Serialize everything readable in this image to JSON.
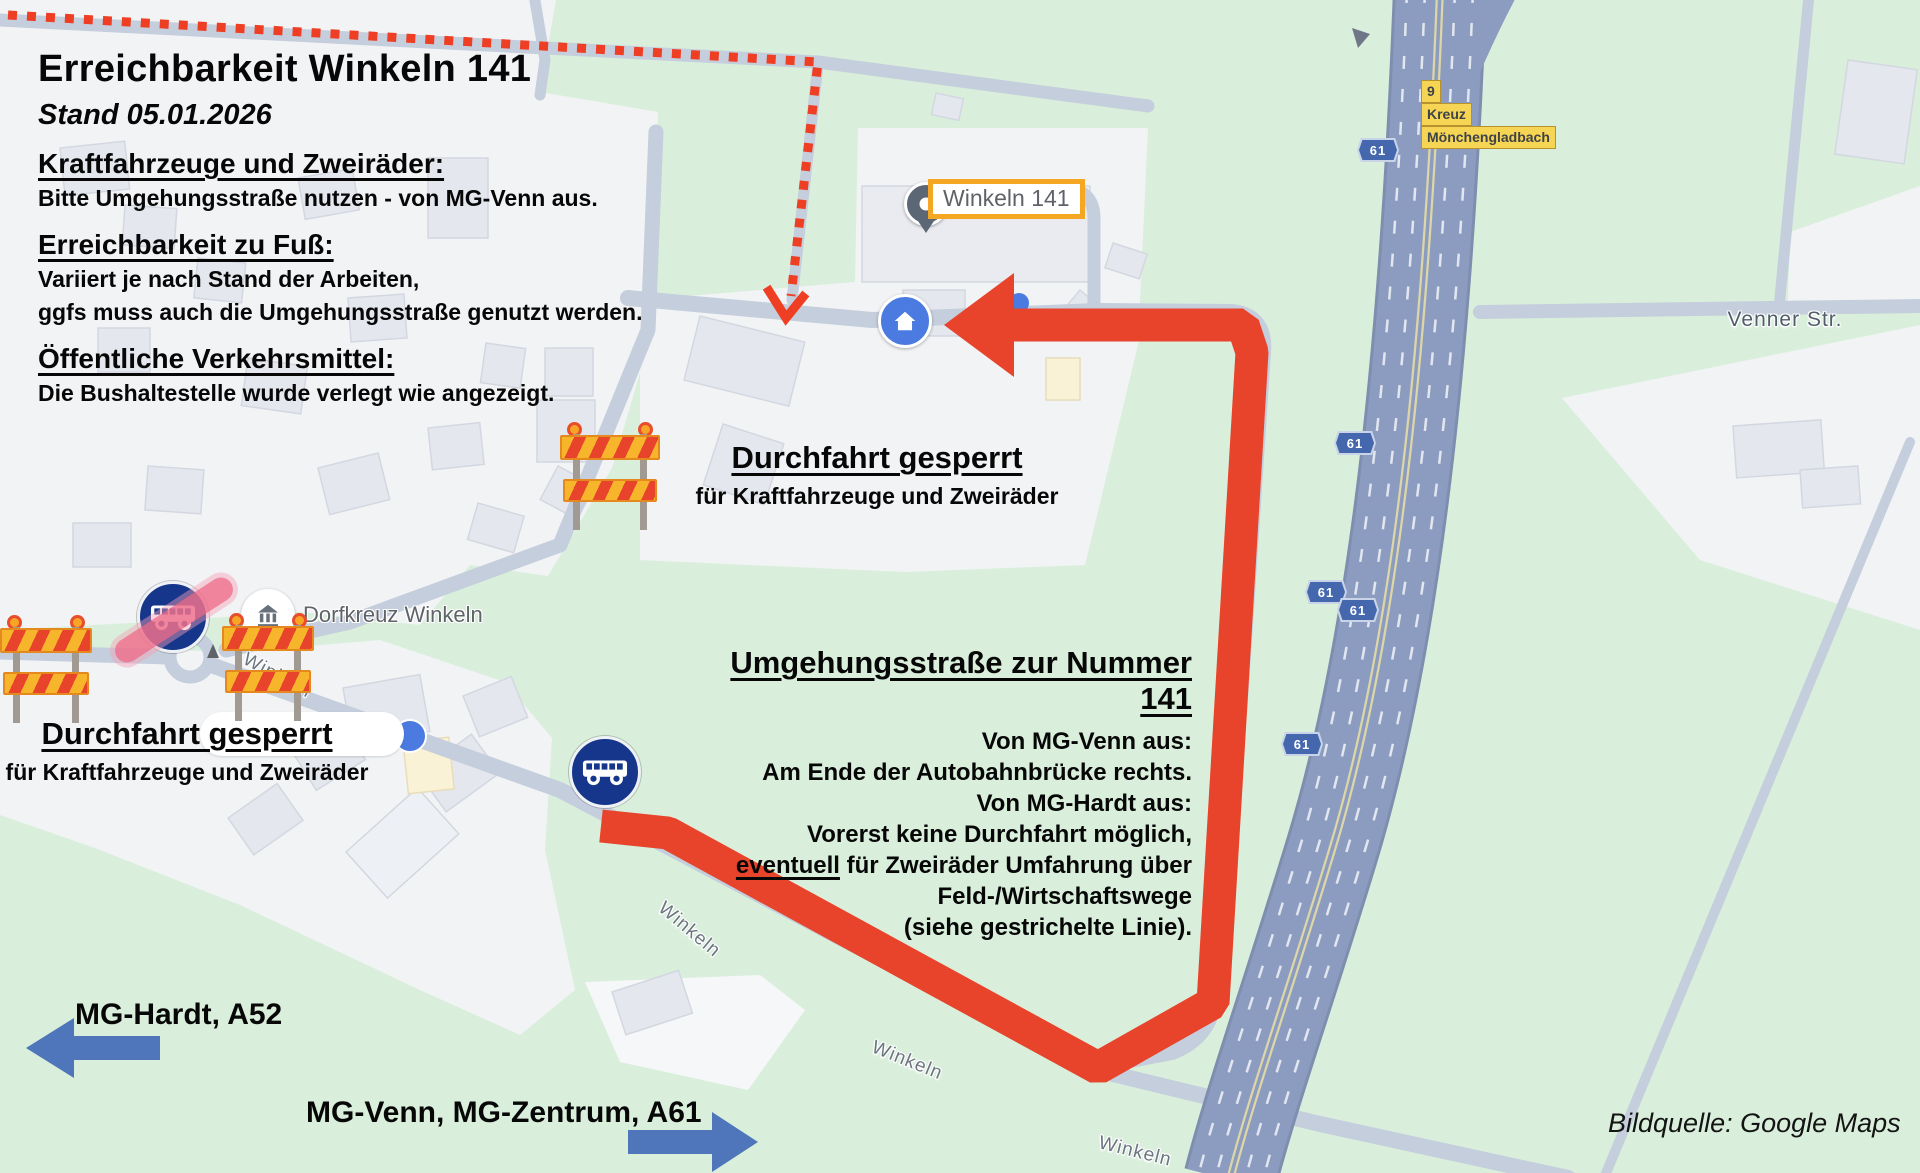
{
  "info_panel": {
    "title": "Erreichbarkeit Winkeln 141",
    "date": "Stand 05.01.2026",
    "sections": [
      {
        "heading": "Kraftfahrzeuge und Zweiräder:",
        "lines": [
          "Bitte Umgehungsstraße nutzen - von MG-Venn aus."
        ]
      },
      {
        "heading": "Erreichbarkeit zu Fuß:",
        "lines": [
          "Variiert je nach Stand der Arbeiten,",
          "ggfs muss auch die Umgehungsstraße genutzt werden."
        ]
      },
      {
        "heading": "Öffentliche Verkehrsmittel:",
        "lines": [
          "Die Bushaltestelle wurde verlegt wie angezeigt."
        ]
      }
    ]
  },
  "closures": {
    "center": {
      "title": "Durchfahrt gesperrt",
      "subtitle": "für Kraftfahrzeuge und Zweiräder"
    },
    "west": {
      "title": "Durchfahrt gesperrt",
      "subtitle": "für Kraftfahrzeuge und Zweiräder"
    }
  },
  "detour": {
    "heading": "Umgehungsstraße zur Nummer 141",
    "lines": [
      "Von MG-Venn aus:",
      "Am Ende der Autobahnbrücke rechts.",
      "Von MG-Hardt aus:",
      "Vorerst keine Durchfahrt möglich,"
    ],
    "emphasis_word": "eventuell",
    "emphasis_rest": " für Zweiräder Umfahrung über",
    "lines_tail": [
      "Feld-/Wirtschaftswege",
      "(siehe gestrichelte Linie)."
    ]
  },
  "directions": {
    "west": "MG-Hardt, A52",
    "southeast": "MG-Venn, MG-Zentrum, A61"
  },
  "map": {
    "poi_winkeln141": "Winkeln 141",
    "poi_dorfkreuz": "Dorfkreuz Winkeln",
    "street_winkeln": "Winkeln",
    "street_venner": "Venner Str.",
    "motorway_shield": "61",
    "exit_sign": {
      "number": "9",
      "line1": "Kreuz",
      "line2": "Mönchengladbach"
    }
  },
  "credit": "Bildquelle: Google Maps",
  "colors": {
    "map_green": "#d9efdc",
    "urban": "#f2f3f5",
    "road": "#c5cedc",
    "highway": "#8c9cc0",
    "route_red": "#e8432b",
    "cross_pink": "#ee708c",
    "sign_navy": "#16368c",
    "google_blue": "#4b7be0",
    "direction_blue": "#4f75ba",
    "marker_orange": "#f5a623",
    "exit_yellow": "#f7d554"
  }
}
